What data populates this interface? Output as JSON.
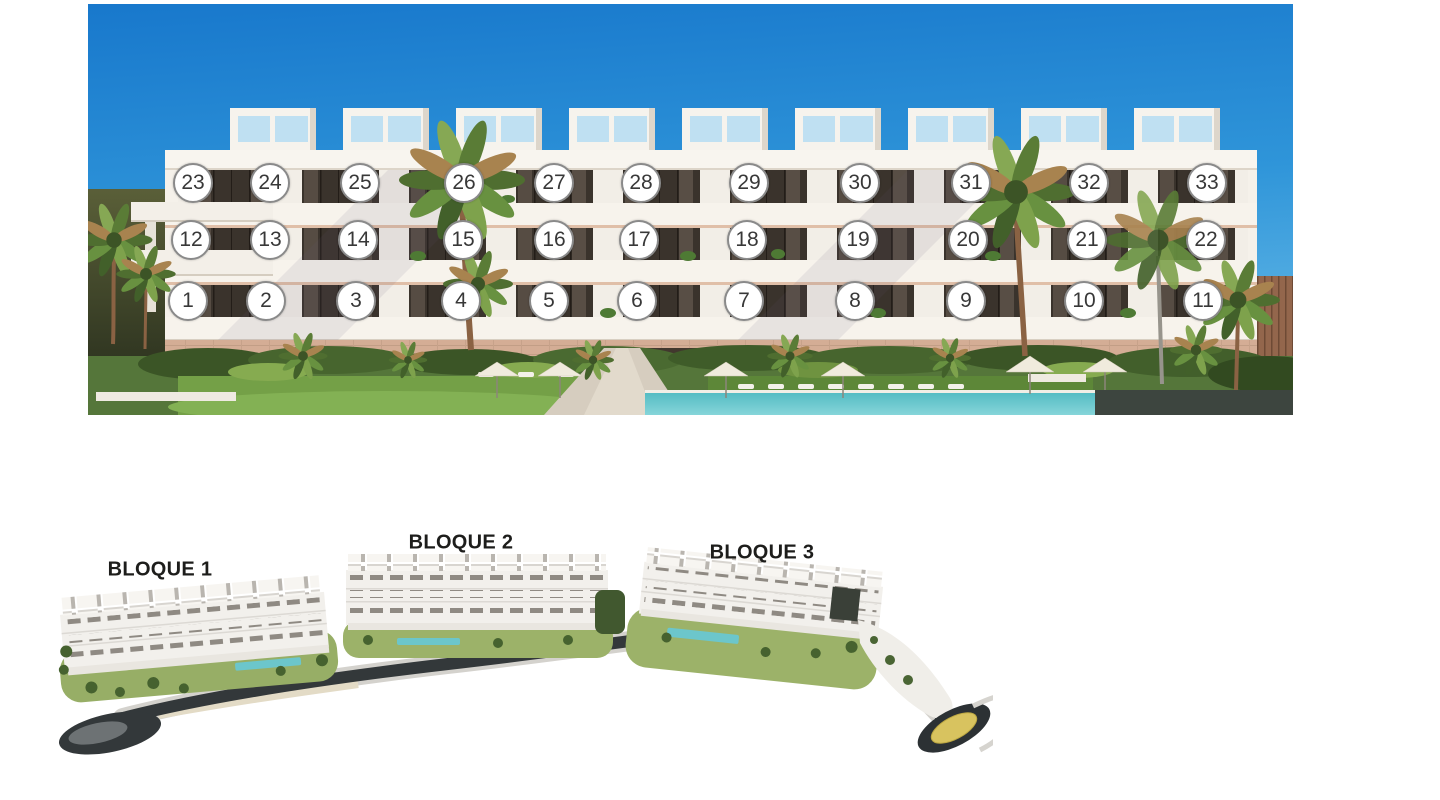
{
  "front_view": {
    "title": "building-front-elevation-with-unit-numbers",
    "marker": {
      "fill": "#ffffff",
      "border": "#8a8a8a",
      "text_color": "#383838"
    },
    "floors": [
      {
        "row": "top-floor",
        "y": 183,
        "units": [
          {
            "n": 23,
            "x": 193
          },
          {
            "n": 24,
            "x": 270
          },
          {
            "n": 25,
            "x": 360
          },
          {
            "n": 26,
            "x": 464
          },
          {
            "n": 27,
            "x": 554
          },
          {
            "n": 28,
            "x": 641
          },
          {
            "n": 29,
            "x": 749
          },
          {
            "n": 30,
            "x": 860
          },
          {
            "n": 31,
            "x": 971
          },
          {
            "n": 32,
            "x": 1089
          },
          {
            "n": 33,
            "x": 1207
          }
        ]
      },
      {
        "row": "middle-floor",
        "y": 240,
        "units": [
          {
            "n": 12,
            "x": 191
          },
          {
            "n": 13,
            "x": 270
          },
          {
            "n": 14,
            "x": 358
          },
          {
            "n": 15,
            "x": 463
          },
          {
            "n": 16,
            "x": 554
          },
          {
            "n": 17,
            "x": 639
          },
          {
            "n": 18,
            "x": 747
          },
          {
            "n": 19,
            "x": 858
          },
          {
            "n": 20,
            "x": 968
          },
          {
            "n": 21,
            "x": 1087
          },
          {
            "n": 22,
            "x": 1206
          }
        ]
      },
      {
        "row": "ground-floor",
        "y": 301,
        "units": [
          {
            "n": 1,
            "x": 188
          },
          {
            "n": 2,
            "x": 266
          },
          {
            "n": 3,
            "x": 356
          },
          {
            "n": 4,
            "x": 461
          },
          {
            "n": 5,
            "x": 549
          },
          {
            "n": 6,
            "x": 637
          },
          {
            "n": 7,
            "x": 744
          },
          {
            "n": 8,
            "x": 855
          },
          {
            "n": 9,
            "x": 966
          },
          {
            "n": 10,
            "x": 1084
          },
          {
            "n": 11,
            "x": 1203
          }
        ]
      }
    ]
  },
  "site_plan": {
    "blocks": [
      {
        "label": "BLOQUE 1",
        "x": 160,
        "y": 570
      },
      {
        "label": "BLOQUE 2",
        "x": 461,
        "y": 543
      },
      {
        "label": "BLOQUE 3",
        "x": 762,
        "y": 553
      }
    ]
  },
  "colors": {
    "sky_top": "#1878cc",
    "sky_bottom": "#62b7e6",
    "pool": "#5ec3c9",
    "dark_panel": "#3d453f",
    "road": "#33383a",
    "roundabout_gold": "#d8c35f",
    "marker_border": "#8a8a8a",
    "label_text": "#1d1d1b"
  }
}
